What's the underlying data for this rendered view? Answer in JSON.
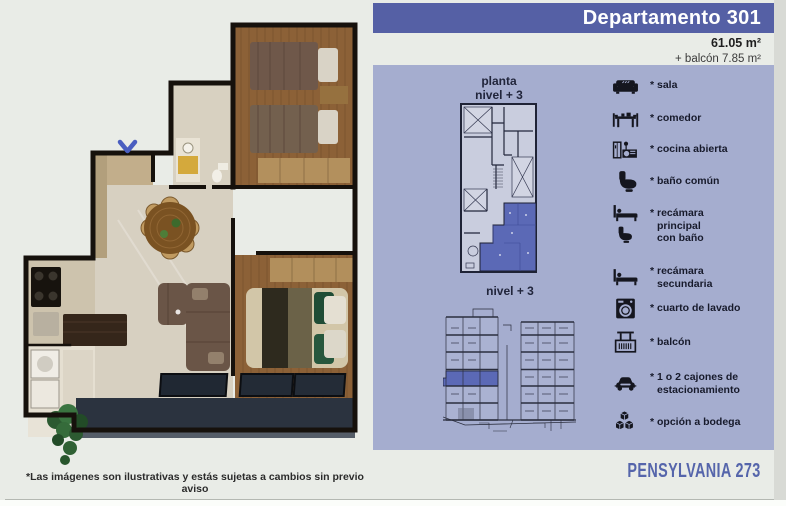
{
  "header": {
    "title": "Departamento 301"
  },
  "area": {
    "size": "61.05 m²",
    "balcony": "+ balcón 7.85 m²"
  },
  "plans": {
    "floor_plan_label": "planta\nnivel + 3",
    "section_label": "nivel + 3"
  },
  "legend": {
    "items": [
      {
        "icon": "sofa-icon",
        "label": "* sala"
      },
      {
        "icon": "dining-table-icon",
        "label": "* comedor"
      },
      {
        "icon": "kitchen-icon",
        "label": "* cocina abierta"
      },
      {
        "icon": "toilet-icon",
        "label": "* baño común"
      },
      {
        "icon": "bed-with-bath-icon",
        "label": "* recámara\nprincipal\ncon baño"
      },
      {
        "icon": "bed-icon",
        "label": "* recámara\nsecundaria"
      },
      {
        "icon": "washing-machine-icon",
        "label": "* cuarto de lavado"
      },
      {
        "icon": "balcony-icon",
        "label": "* balcón"
      },
      {
        "icon": "car-icon",
        "label": "* 1 o 2 cajones de\nestacionamiento"
      },
      {
        "icon": "storage-boxes-icon",
        "label": "* opción a bodega"
      }
    ]
  },
  "footer": {
    "brand": "PENSYLVANIA 273",
    "disclaimer": "*Las imágenes son ilustrativas y estás sujetas a cambios sin previo aviso"
  },
  "colors": {
    "page_bg": "#e9ece7",
    "header_bg": "#5560a5",
    "panel_bg": "#a5adcf",
    "unit_highlight": "#5b69b6",
    "brand_text": "#5565ab"
  }
}
